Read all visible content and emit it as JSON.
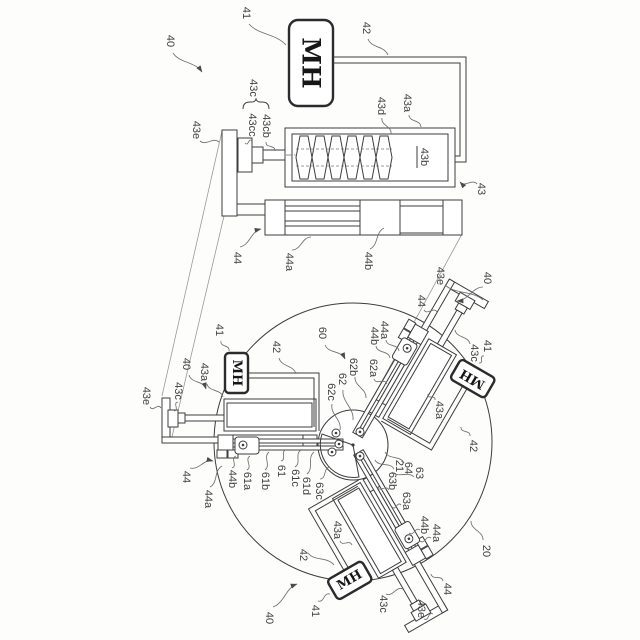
{
  "figure": {
    "type": "patent-line-drawing",
    "mh_label": "MH",
    "line_color": "#3d3d3d",
    "background": "#fdfdfc",
    "views": {
      "detail_view": "single MH actuator unit (40): MH canister, wire 42, screw housing 43 (43a/43b/43d), shaft 43c (43cc/43cb), bracket 43e, linear rails 44 (44a/44b)",
      "assembly_view": "circular plate 60 with three actuator units 40 at 120 degrees driving central hub 64/21 via arms 61, 62, 63; overall device 20"
    },
    "labels": [
      [
        "40",
        170,
        41,
        173,
        53,
        202,
        72,
        "a"
      ],
      [
        "41",
        246,
        13,
        249,
        24,
        286,
        45,
        ""
      ],
      [
        "42",
        366,
        28,
        368,
        39,
        388,
        55,
        ""
      ],
      [
        "43c",
        253,
        88,
        null,
        null,
        null,
        null,
        ""
      ],
      [
        "43cc",
        252,
        125,
        252,
        141,
        245,
        143,
        ""
      ],
      [
        "43cb",
        266,
        126,
        266,
        142,
        275,
        151,
        ""
      ],
      [
        "43e",
        196,
        130,
        200,
        141,
        219,
        142,
        ""
      ],
      [
        "43d",
        381,
        106,
        382,
        118,
        391,
        134,
        ""
      ],
      [
        "43a",
        407,
        103,
        409,
        115,
        421,
        127,
        ""
      ],
      [
        "43b",
        424,
        157,
        null,
        null,
        null,
        null,
        "u"
      ],
      [
        "43",
        481,
        189,
        477,
        184,
        460,
        182,
        "a"
      ],
      [
        "44",
        237,
        258,
        240,
        247,
        261,
        229,
        "a"
      ],
      [
        "44a",
        289,
        262,
        292,
        250,
        311,
        237,
        ""
      ],
      [
        "44b",
        368,
        261,
        370,
        249,
        384,
        228,
        ""
      ],
      [
        "60",
        322,
        333,
        325,
        345,
        345,
        359,
        "a"
      ],
      [
        "20",
        486,
        551,
        483,
        540,
        471,
        521,
        ""
      ],
      [
        "43e",
        146,
        396,
        150,
        407,
        161,
        408,
        ""
      ],
      [
        "43c",
        178,
        391,
        178,
        402,
        174,
        411,
        ""
      ],
      [
        "40",
        186,
        364,
        189,
        375,
        206,
        389,
        "a"
      ],
      [
        "43a",
        204,
        372,
        207,
        384,
        223,
        397,
        ""
      ],
      [
        "41",
        219,
        330,
        221,
        341,
        229,
        351,
        ""
      ],
      [
        "42",
        276,
        347,
        279,
        358,
        296,
        374,
        ""
      ],
      [
        "44",
        186,
        477,
        190,
        468,
        213,
        461,
        "a"
      ],
      [
        "44a",
        208,
        499,
        210,
        487,
        222,
        466,
        ""
      ],
      [
        "44b",
        232,
        479,
        232,
        468,
        236,
        456,
        ""
      ],
      [
        "61a",
        247,
        481,
        247,
        470,
        250,
        456,
        ""
      ],
      [
        "61b",
        265,
        481,
        265,
        470,
        269,
        452,
        ""
      ],
      [
        "61",
        281,
        471,
        281,
        461,
        286,
        450,
        ""
      ],
      [
        "61c",
        295,
        478,
        295,
        467,
        301,
        450,
        ""
      ],
      [
        "61d",
        306,
        486,
        307,
        474,
        314,
        452,
        ""
      ],
      [
        "63c",
        319,
        491,
        320,
        479,
        330,
        467,
        ""
      ],
      [
        "62c",
        331,
        392,
        332,
        404,
        340,
        430,
        ""
      ],
      [
        "62",
        342,
        379,
        343,
        390,
        353,
        420,
        ""
      ],
      [
        "62b",
        353,
        367,
        355,
        377,
        366,
        398,
        ""
      ],
      [
        "62a",
        373,
        368,
        374,
        379,
        387,
        384,
        ""
      ],
      [
        "63b",
        392,
        481,
        389,
        490,
        377,
        487,
        ""
      ],
      [
        "21",
        399,
        466,
        394,
        469,
        375,
        460,
        ""
      ],
      [
        "64",
        408,
        468,
        404,
        463,
        385,
        452,
        ""
      ],
      [
        "63",
        419,
        473,
        414,
        477,
        392,
        472,
        ""
      ],
      [
        "63a",
        406,
        501,
        401,
        505,
        392,
        507,
        ""
      ],
      [
        "43e",
        440,
        276,
        445,
        285,
        483,
        300,
        ""
      ],
      [
        "40",
        487,
        278,
        483,
        287,
        457,
        301,
        "a"
      ],
      [
        "44",
        421,
        301,
        424,
        310,
        437,
        312,
        ""
      ],
      [
        "44a",
        384,
        330,
        386,
        340,
        399,
        351,
        ""
      ],
      [
        "44b",
        374,
        336,
        376,
        346,
        390,
        358,
        ""
      ],
      [
        "43c",
        474,
        353,
        470,
        344,
        455,
        330,
        ""
      ],
      [
        "41",
        487,
        346,
        484,
        356,
        479,
        363,
        ""
      ],
      [
        "43a",
        439,
        410,
        435,
        400,
        428,
        394,
        ""
      ],
      [
        "42",
        473,
        446,
        470,
        436,
        461,
        427,
        ""
      ],
      [
        "41",
        315,
        611,
        318,
        601,
        330,
        594,
        ""
      ],
      [
        "40",
        269,
        618,
        273,
        607,
        297,
        584,
        "a"
      ],
      [
        "42",
        303,
        555,
        308,
        553,
        334,
        565,
        ""
      ],
      [
        "43a",
        337,
        530,
        340,
        541,
        352,
        545,
        ""
      ],
      [
        "43c",
        383,
        604,
        386,
        594,
        403,
        589,
        ""
      ],
      [
        "43e",
        421,
        609,
        424,
        619,
        433,
        614,
        ""
      ],
      [
        "44",
        447,
        589,
        443,
        581,
        431,
        574,
        ""
      ],
      [
        "44a",
        436,
        533,
        431,
        538,
        420,
        541,
        ""
      ],
      [
        "44b",
        424,
        525,
        420,
        530,
        409,
        533,
        ""
      ]
    ]
  }
}
